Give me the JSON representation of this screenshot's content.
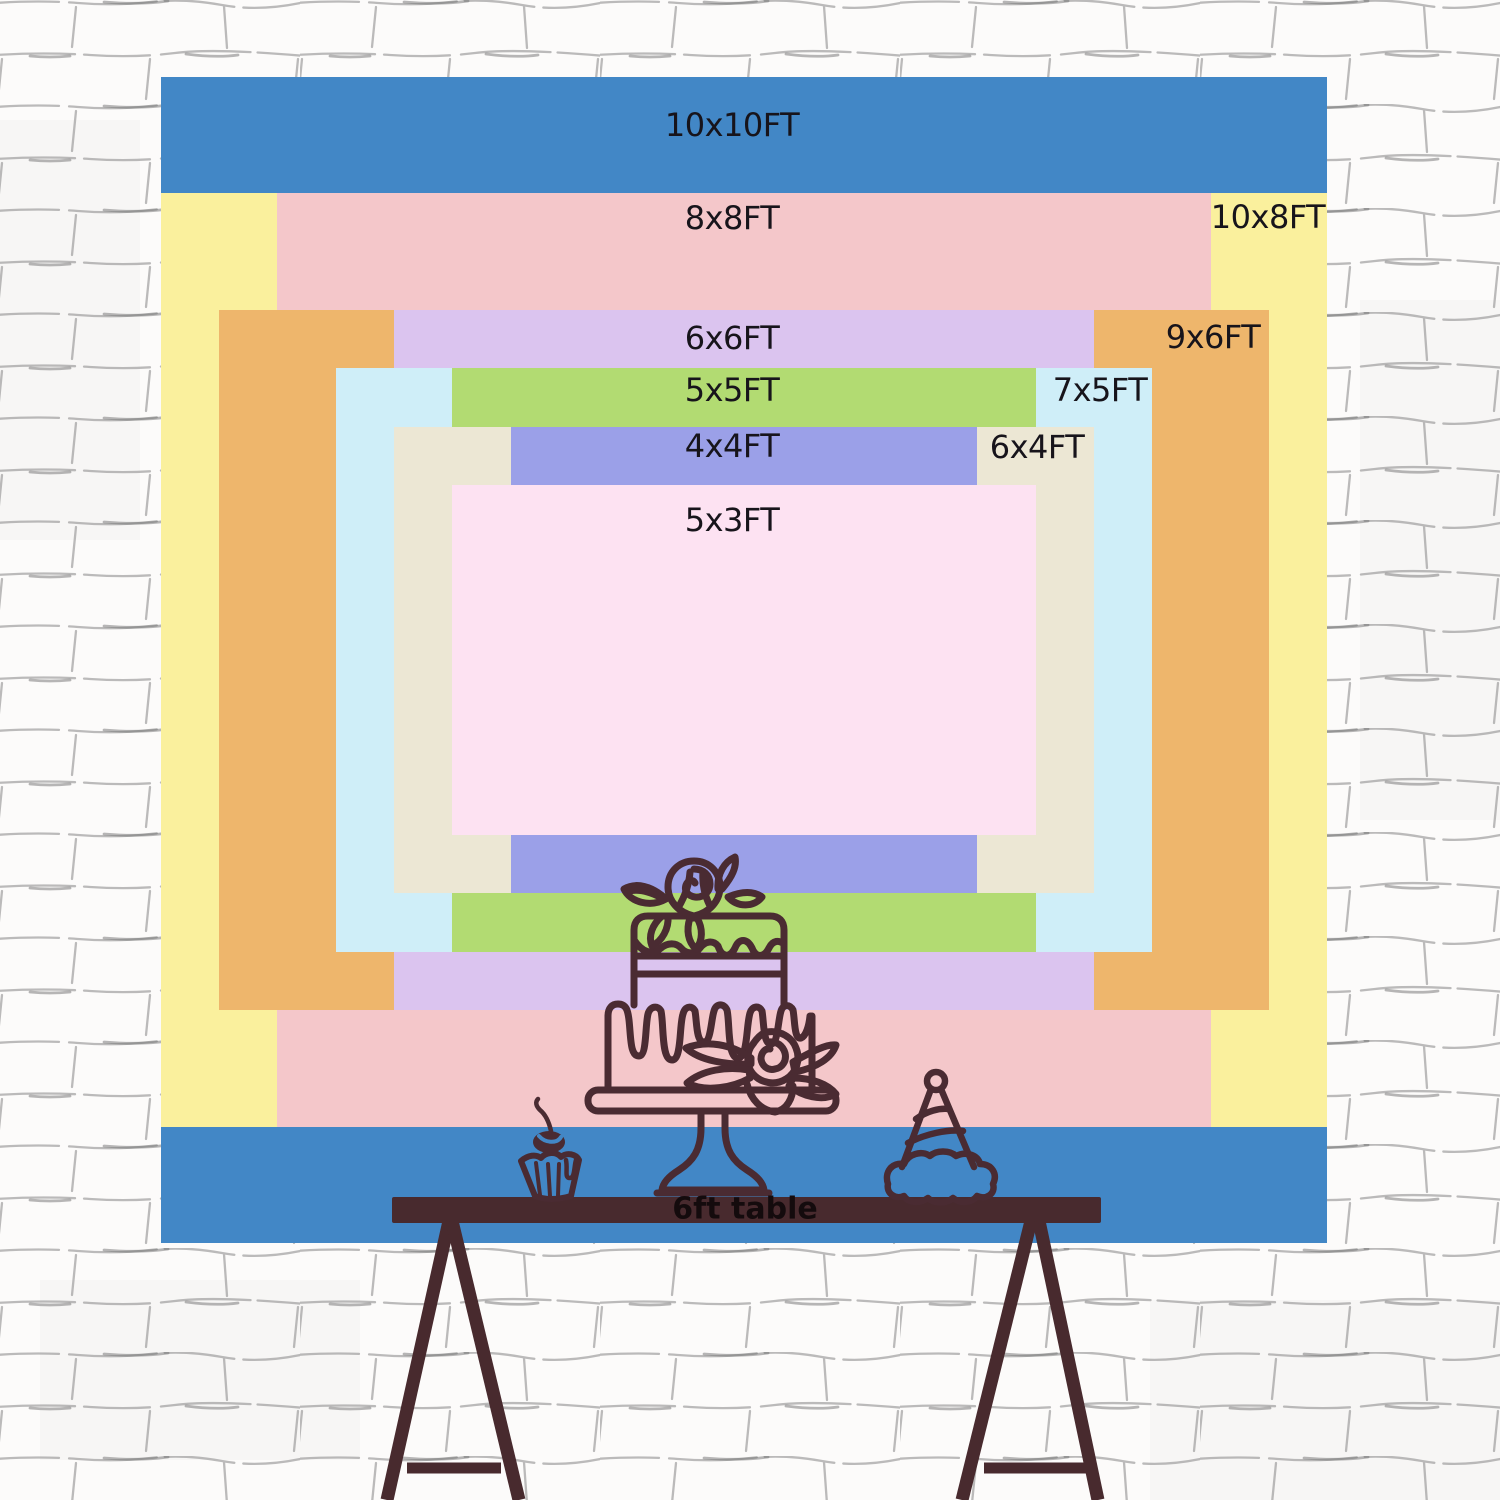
{
  "sizes": [
    {
      "label": "10x10FT",
      "width_ft": 10,
      "height_ft": 10,
      "color": "#4287c6"
    },
    {
      "label": "10x8FT",
      "width_ft": 10,
      "height_ft": 8,
      "color": "#faf09d"
    },
    {
      "label": "8x8FT",
      "width_ft": 8,
      "height_ft": 8,
      "color": "#f4c7ca"
    },
    {
      "label": "9x6FT",
      "width_ft": 9,
      "height_ft": 6,
      "color": "#eeb66c"
    },
    {
      "label": "6x6FT",
      "width_ft": 6,
      "height_ft": 6,
      "color": "#dbc4ef"
    },
    {
      "label": "7x5FT",
      "width_ft": 7,
      "height_ft": 5,
      "color": "#cfeef8"
    },
    {
      "label": "5x5FT",
      "width_ft": 5,
      "height_ft": 5,
      "color": "#b2db72"
    },
    {
      "label": "6x4FT",
      "width_ft": 6,
      "height_ft": 4,
      "color": "#ece7d4"
    },
    {
      "label": "4x4FT",
      "width_ft": 4,
      "height_ft": 4,
      "color": "#9ba0e8"
    },
    {
      "label": "5x3FT",
      "width_ft": 5,
      "height_ft": 3,
      "color": "#fde2f2"
    }
  ],
  "label_text_color": "#17141b",
  "table": {
    "label": "6ft table",
    "length_ft": 6,
    "color": "#482a2e",
    "label_color": "#140b0d"
  },
  "artwork": {
    "outline_color": "#4a2b32",
    "icons": [
      "two-tier-cake-icon",
      "cupcake-icon",
      "party-hat-icon"
    ]
  },
  "wall": {
    "base_color": "#fcfbfa",
    "mortar_color": "#8f8f8f"
  }
}
